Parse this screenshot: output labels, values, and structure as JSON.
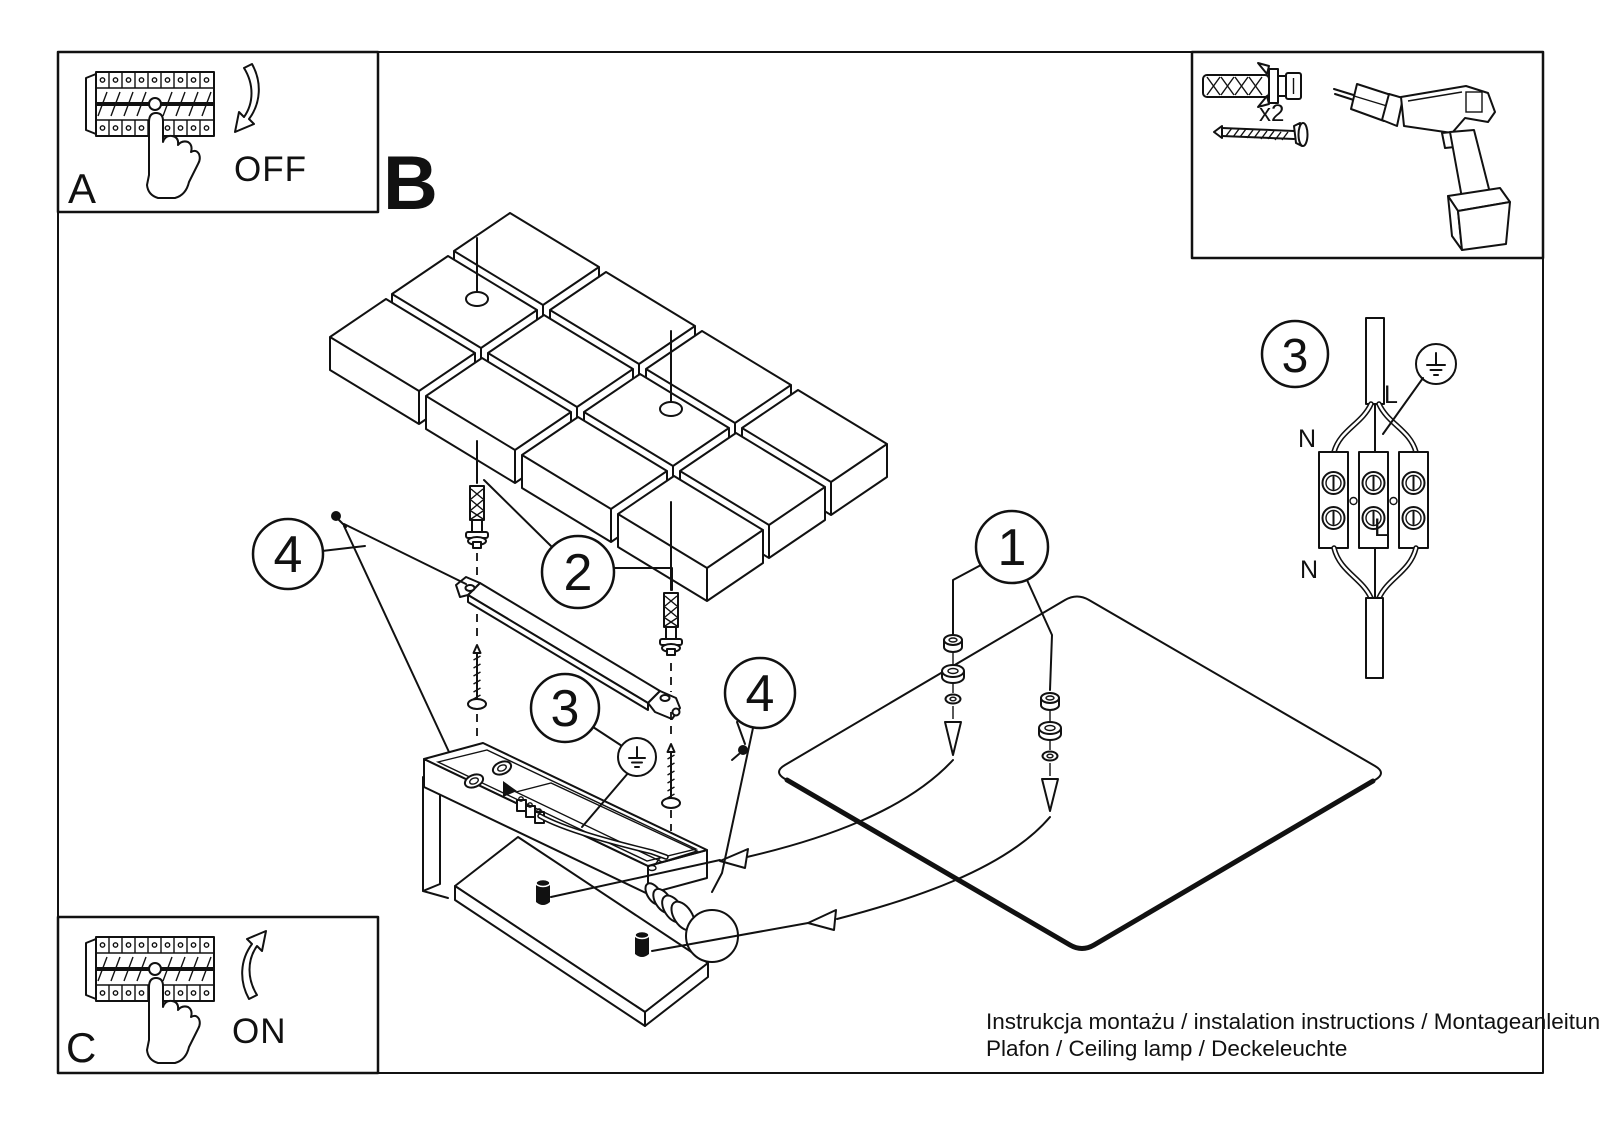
{
  "page": {
    "footer_line1": "Instrukcja montażu / instalation instructions / Montageanleitung",
    "footer_line2": "Plafon / Ceiling lamp / Deckeleuchte"
  },
  "steps": {
    "a": {
      "label": "A",
      "action": "OFF"
    },
    "b": {
      "label": "B"
    },
    "c": {
      "label": "C",
      "action": "ON"
    }
  },
  "tools": {
    "anchor_quantity": "x2"
  },
  "callouts": {
    "panel": "1",
    "bracket": "2",
    "ground": "3",
    "screws": "4"
  },
  "wiring": {
    "step_number": "3",
    "neutral_top": "N",
    "neutral_bottom": "N",
    "live_top": "L",
    "live_bottom": "L"
  },
  "colors": {
    "ink": "#111111",
    "paper": "#ffffff"
  }
}
